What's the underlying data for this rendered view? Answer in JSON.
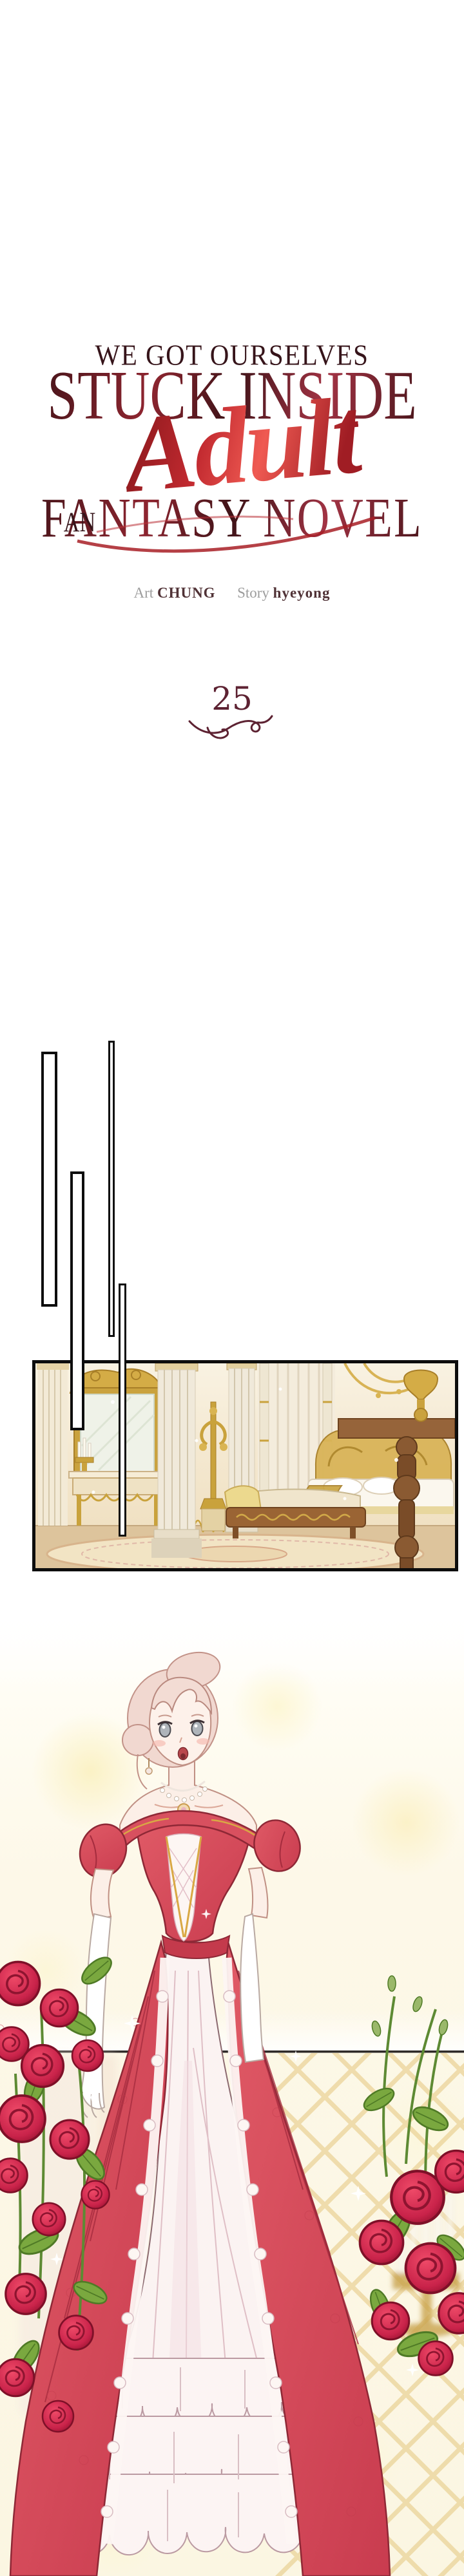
{
  "series": {
    "title_line1": "WE GOT OURSELVES",
    "title_line2": "STUCK INSIDE",
    "title_article": "AN",
    "title_script": "Adult",
    "title_line3": "FANTASY NOVEL"
  },
  "credits": {
    "art_label": "Art",
    "art_name": "CHUNG",
    "story_label": "Story",
    "story_name": "hyeyong"
  },
  "episode": {
    "number": "25"
  },
  "colors": {
    "ink_dark": "#36141a",
    "title_maroon": "#7c222c",
    "script_red": "#bb2329",
    "credit_gray": "#9d9d9d",
    "credit_name": "#503236",
    "episode_maroon": "#5d2232",
    "frame_black": "#0d0d0d",
    "wall_cream": "#f5ecd8",
    "gold": "#c9a23c",
    "wood_brown": "#8a5a32",
    "floor_tan": "#ddc49c",
    "dress_red": "#d8505f",
    "dress_deep": "#a52c3e",
    "lace_white": "#fdf6f3",
    "underskirt_pink": "#f6e7e6",
    "rose_red": "#c9234a",
    "leaf_green": "#76a23e",
    "lattice_gold": "#e6cb86",
    "skin": "#fcefe7",
    "hair_pink": "#f1d8d0",
    "bokeh_yellow": "#fbf3cf"
  },
  "art": {
    "panel_description": "Opulent golden palace bedroom with gilded mirror, marble columns, canopy bed, chaise and patterned rug",
    "illustration_description": "Pale-haired woman in an off-shoulder red ball gown with white lace underskirt, standing before a gold trellis among red roses"
  }
}
